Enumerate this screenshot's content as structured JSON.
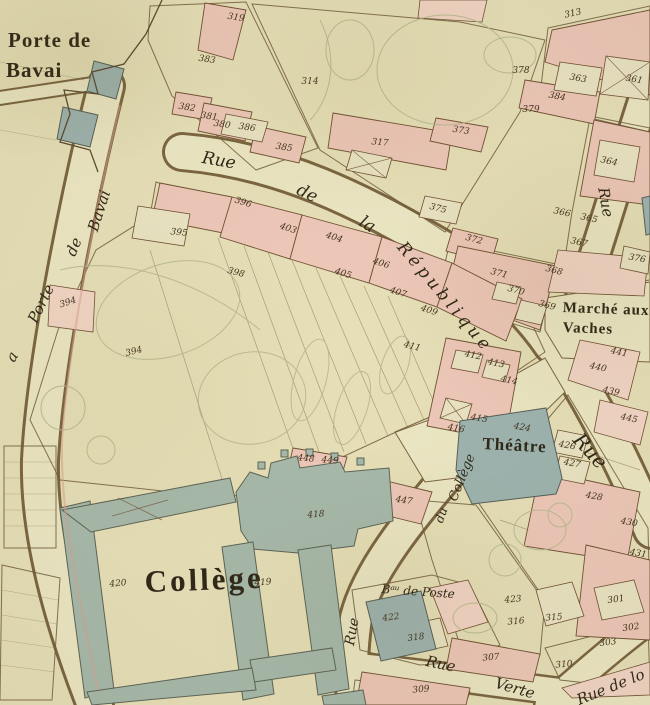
{
  "palette": {
    "parchment": "#e7e0b8",
    "street": "#ece7c4",
    "building_pink": "#eec8b9",
    "building_pink_light": "#f3d6c6",
    "court": "#eae4c4",
    "public_blue": "#a7baac",
    "public_blue_theatre": "#9eb4b0",
    "ink": "#6b5736",
    "garden_olive": "#b6ba8e",
    "label_text": "#2e2718"
  },
  "map": {
    "labels": [
      {
        "name": "porte-de-bavai-line1",
        "text": "Porte de",
        "x": 8,
        "y": 28,
        "size": 21,
        "r": 0,
        "cls": "serif"
      },
      {
        "name": "porte-de-bavai-line2",
        "text": "Bavai",
        "x": 6,
        "y": 58,
        "size": 21,
        "r": 0,
        "cls": "serif"
      },
      {
        "name": "rue-de-la-porte-de-bavai-seg1",
        "text": "Bavai",
        "x": 84,
        "y": 228,
        "size": 15,
        "r": -72,
        "cls": "cursive"
      },
      {
        "name": "rue-de-la-porte-de-bavai-seg2",
        "text": "de",
        "x": 62,
        "y": 252,
        "size": 15,
        "r": -68,
        "cls": "cursive"
      },
      {
        "name": "rue-de-la-porte-de-bavai-seg3",
        "text": "Porte",
        "x": 24,
        "y": 318,
        "size": 15,
        "r": -64,
        "cls": "cursive"
      },
      {
        "name": "rue-de-la-porte-de-bavai-seg4",
        "text": "a",
        "x": 2,
        "y": 356,
        "size": 15,
        "r": -60,
        "cls": "cursive"
      },
      {
        "name": "rue-de-la-republique-seg1",
        "text": "Rue",
        "x": 204,
        "y": 148,
        "size": 17,
        "r": 10,
        "cls": "cursive"
      },
      {
        "name": "rue-de-la-republique-seg2",
        "text": "de",
        "x": 302,
        "y": 180,
        "size": 17,
        "r": 26,
        "cls": "cursive"
      },
      {
        "name": "rue-de-la-republique-seg3",
        "text": "la",
        "x": 366,
        "y": 212,
        "size": 17,
        "r": 32,
        "cls": "cursive"
      },
      {
        "name": "rue-de-la-republique-seg4",
        "text": "République",
        "x": 408,
        "y": 238,
        "size": 17,
        "r": 50,
        "ls": 4,
        "cls": "cursive"
      },
      {
        "name": "rue-right-side",
        "text": "Rue",
        "x": 612,
        "y": 186,
        "size": 15,
        "r": 80,
        "cls": "cursive"
      },
      {
        "name": "marche-aux-vaches-line1",
        "text": "Marché aux",
        "x": 563,
        "y": 300,
        "size": 15,
        "r": 2,
        "cls": "serif"
      },
      {
        "name": "marche-aux-vaches-line2",
        "text": "Vaches",
        "x": 563,
        "y": 320,
        "size": 15,
        "r": 2,
        "cls": "serif"
      },
      {
        "name": "theatre",
        "text": "Théâtre",
        "x": 483,
        "y": 434,
        "size": 17,
        "r": 3,
        "cls": "serif"
      },
      {
        "name": "rue-southeast",
        "text": "Rue",
        "x": 586,
        "y": 428,
        "size": 20,
        "r": 48,
        "cls": "cursive"
      },
      {
        "name": "college",
        "text": "Collège",
        "x": 144,
        "y": 564,
        "size": 31,
        "r": -2,
        "ls": 3,
        "cls": "serif"
      },
      {
        "name": "rue-du-college-seg1",
        "text": "Collège",
        "x": 446,
        "y": 498,
        "size": 13,
        "r": -68,
        "cls": "cursive"
      },
      {
        "name": "rue-du-college-seg2",
        "text": "du",
        "x": 432,
        "y": 520,
        "size": 12,
        "r": -70,
        "cls": "cursive"
      },
      {
        "name": "rue-du-college-seg3",
        "text": "Rue",
        "x": 342,
        "y": 644,
        "size": 14,
        "r": -80,
        "cls": "cursive"
      },
      {
        "name": "bureau-de-poste",
        "text": "Bᵃᵘ de Poste",
        "x": 382,
        "y": 582,
        "size": 12,
        "r": 4,
        "cls": "cursive"
      },
      {
        "name": "rue-verte-seg1",
        "text": "Rue",
        "x": 428,
        "y": 652,
        "size": 15,
        "r": 12,
        "cls": "cursive"
      },
      {
        "name": "rue-verte-seg2",
        "text": "Verte",
        "x": 498,
        "y": 674,
        "size": 15,
        "r": 16,
        "cls": "cursive"
      },
      {
        "name": "rue-de-lo",
        "text": "Rue de lo",
        "x": 574,
        "y": 692,
        "size": 15,
        "r": -22,
        "cls": "cursive"
      }
    ],
    "parcel_numbers": [
      {
        "n": "319",
        "x": 236,
        "y": 18,
        "r": 8
      },
      {
        "n": "383",
        "x": 207,
        "y": 60,
        "r": 8
      },
      {
        "n": "382",
        "x": 187,
        "y": 108,
        "r": 8
      },
      {
        "n": "381",
        "x": 209,
        "y": 117,
        "r": 8
      },
      {
        "n": "380",
        "x": 222,
        "y": 125,
        "r": 8
      },
      {
        "n": "386",
        "x": 247,
        "y": 128,
        "r": 8
      },
      {
        "n": "385",
        "x": 284,
        "y": 148,
        "r": 8
      },
      {
        "n": "314",
        "x": 310,
        "y": 82,
        "r": 0
      },
      {
        "n": "317",
        "x": 380,
        "y": 143,
        "r": 5
      },
      {
        "n": "313",
        "x": 573,
        "y": 14,
        "r": -12
      },
      {
        "n": "378",
        "x": 521,
        "y": 71,
        "r": 0
      },
      {
        "n": "384",
        "x": 557,
        "y": 97,
        "r": 10
      },
      {
        "n": "379",
        "x": 531,
        "y": 110,
        "r": 0
      },
      {
        "n": "363",
        "x": 578,
        "y": 79,
        "r": 10
      },
      {
        "n": "361",
        "x": 634,
        "y": 80,
        "r": 10
      },
      {
        "n": "373",
        "x": 461,
        "y": 131,
        "r": 8
      },
      {
        "n": "364",
        "x": 609,
        "y": 162,
        "r": 12
      },
      {
        "n": "375",
        "x": 438,
        "y": 209,
        "r": 15
      },
      {
        "n": "372",
        "x": 474,
        "y": 240,
        "r": 15
      },
      {
        "n": "371",
        "x": 499,
        "y": 274,
        "r": 15
      },
      {
        "n": "370",
        "x": 516,
        "y": 291,
        "r": 15
      },
      {
        "n": "369",
        "x": 547,
        "y": 306,
        "r": 15
      },
      {
        "n": "368",
        "x": 554,
        "y": 271,
        "r": 15
      },
      {
        "n": "367",
        "x": 579,
        "y": 243,
        "r": 12
      },
      {
        "n": "365",
        "x": 589,
        "y": 219,
        "r": 12
      },
      {
        "n": "366",
        "x": 562,
        "y": 213,
        "r": 12
      },
      {
        "n": "376",
        "x": 637,
        "y": 259,
        "r": 10
      },
      {
        "n": "395",
        "x": 179,
        "y": 233,
        "r": 5
      },
      {
        "n": "396",
        "x": 243,
        "y": 203,
        "r": 18
      },
      {
        "n": "398",
        "x": 236,
        "y": 273,
        "r": 15
      },
      {
        "n": "403",
        "x": 288,
        "y": 229,
        "r": 18
      },
      {
        "n": "404",
        "x": 334,
        "y": 238,
        "r": 18
      },
      {
        "n": "405",
        "x": 343,
        "y": 274,
        "r": 18
      },
      {
        "n": "406",
        "x": 381,
        "y": 264,
        "r": 18
      },
      {
        "n": "407",
        "x": 398,
        "y": 293,
        "r": 18
      },
      {
        "n": "409",
        "x": 429,
        "y": 311,
        "r": 18
      },
      {
        "n": "411",
        "x": 412,
        "y": 347,
        "r": 15
      },
      {
        "n": "394",
        "x": 68,
        "y": 303,
        "r": -18
      },
      {
        "n": "394",
        "x": 134,
        "y": 352,
        "r": -15
      },
      {
        "n": "412",
        "x": 473,
        "y": 356,
        "r": 12
      },
      {
        "n": "413",
        "x": 496,
        "y": 364,
        "r": 12
      },
      {
        "n": "414",
        "x": 509,
        "y": 381,
        "r": 12
      },
      {
        "n": "415",
        "x": 479,
        "y": 419,
        "r": 10
      },
      {
        "n": "416",
        "x": 456,
        "y": 429,
        "r": 10
      },
      {
        "n": "448",
        "x": 306,
        "y": 459,
        "r": 5
      },
      {
        "n": "449",
        "x": 330,
        "y": 461,
        "r": 5
      },
      {
        "n": "447",
        "x": 404,
        "y": 501,
        "r": 8
      },
      {
        "n": "424",
        "x": 522,
        "y": 428,
        "r": 10
      },
      {
        "n": "426",
        "x": 567,
        "y": 446,
        "r": 10
      },
      {
        "n": "427",
        "x": 572,
        "y": 464,
        "r": 10
      },
      {
        "n": "428",
        "x": 594,
        "y": 497,
        "r": 10
      },
      {
        "n": "430",
        "x": 629,
        "y": 523,
        "r": 10
      },
      {
        "n": "431",
        "x": 638,
        "y": 554,
        "r": 10
      },
      {
        "n": "441",
        "x": 619,
        "y": 353,
        "r": 12
      },
      {
        "n": "440",
        "x": 598,
        "y": 368,
        "r": 12
      },
      {
        "n": "439",
        "x": 611,
        "y": 392,
        "r": 12
      },
      {
        "n": "445",
        "x": 629,
        "y": 419,
        "r": 12
      },
      {
        "n": "418",
        "x": 316,
        "y": 515,
        "r": -5
      },
      {
        "n": "420",
        "x": 118,
        "y": 584,
        "r": -5
      },
      {
        "n": "419",
        "x": 263,
        "y": 583,
        "r": -5
      },
      {
        "n": "422",
        "x": 391,
        "y": 618,
        "r": -8
      },
      {
        "n": "423",
        "x": 513,
        "y": 600,
        "r": -5
      },
      {
        "n": "318",
        "x": 416,
        "y": 638,
        "r": -8
      },
      {
        "n": "316",
        "x": 516,
        "y": 622,
        "r": -5
      },
      {
        "n": "315",
        "x": 554,
        "y": 618,
        "r": -5
      },
      {
        "n": "301",
        "x": 616,
        "y": 600,
        "r": -8
      },
      {
        "n": "302",
        "x": 631,
        "y": 628,
        "r": -8
      },
      {
        "n": "303",
        "x": 608,
        "y": 643,
        "r": -8
      },
      {
        "n": "307",
        "x": 491,
        "y": 658,
        "r": -5
      },
      {
        "n": "310",
        "x": 564,
        "y": 665,
        "r": -5
      },
      {
        "n": "309",
        "x": 421,
        "y": 690,
        "r": -5
      }
    ]
  }
}
